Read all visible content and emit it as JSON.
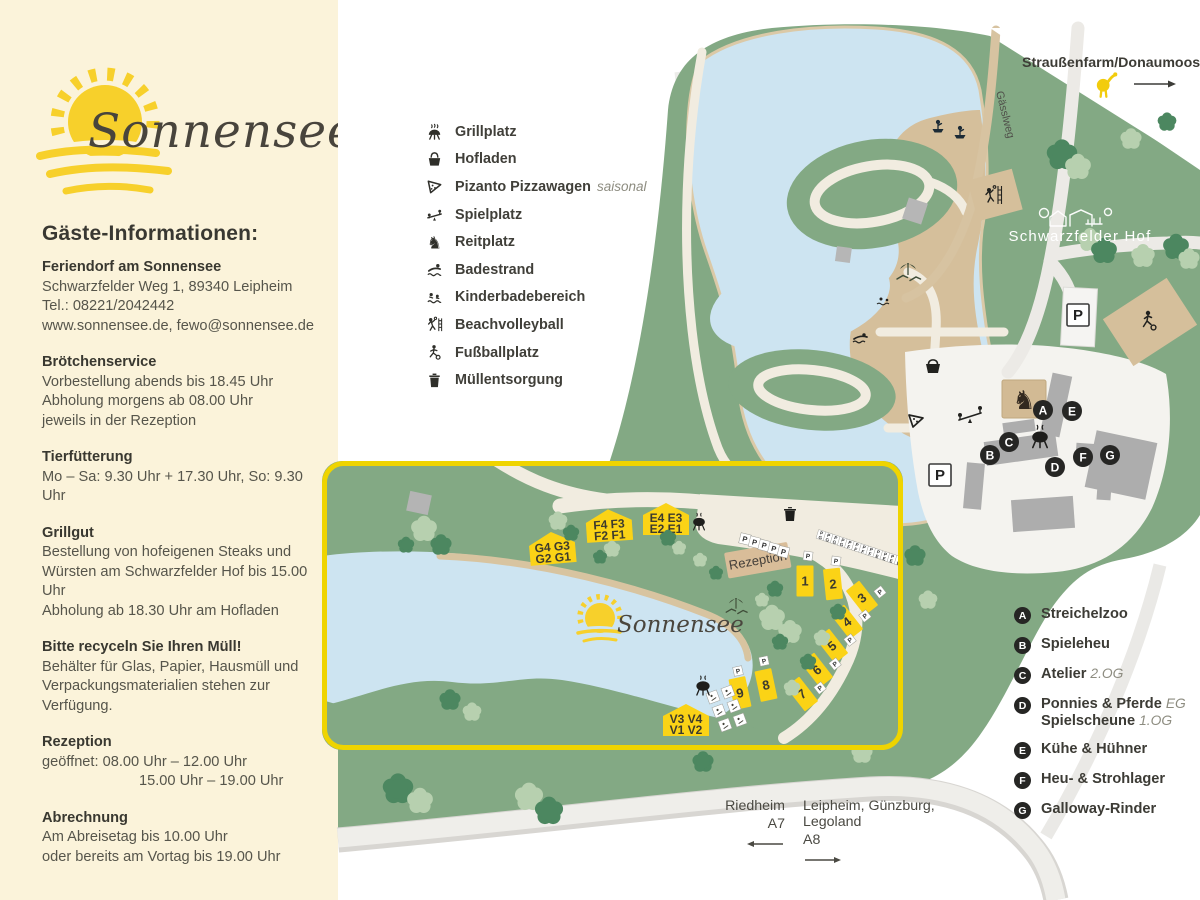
{
  "colors": {
    "sidebar_bg": "#fbf3da",
    "accent_yellow": "#fbd316",
    "inset_border": "#efd400",
    "map_green": "#83a984",
    "lake_blue": "#cde4f1",
    "beach_tan": "#d5bf9b",
    "marker_black": "#262624"
  },
  "sidebar": {
    "logo_text": "Sonnensee",
    "heading": "Gäste-Informationen:",
    "sections": [
      {
        "title": "Feriendorf am Sonnensee",
        "lines": [
          "Schwarzfelder Weg 1, 89340 Leipheim",
          "Tel.: 08221/2042442",
          "www.sonnensee.de, fewo@sonnensee.de"
        ]
      },
      {
        "title": "Brötchenservice",
        "lines": [
          "Vorbestellung abends bis 18.45 Uhr",
          "Abholung morgens ab 08.00 Uhr",
          "jeweils in der Rezeption"
        ]
      },
      {
        "title": "Tierfütterung",
        "lines": [
          "Mo – Sa: 9.30 Uhr + 17.30 Uhr, So: 9.30 Uhr"
        ]
      },
      {
        "title": "Grillgut",
        "lines": [
          "Bestellung von hofeigenen Steaks und",
          "Würsten am Schwarzfelder Hof bis 15.00 Uhr",
          "Abholung ab 18.30 Uhr am Hofladen"
        ]
      },
      {
        "title": "Bitte recyceln Sie Ihren Müll!",
        "lines": [
          "Behälter für Glas, Papier, Hausmüll und",
          "Verpackungsmaterialien stehen zur Verfügung."
        ]
      },
      {
        "title": "Rezeption",
        "lines": [
          "geöffnet: 08.00 Uhr – 12.00 Uhr",
          "15.00 Uhr – 19.00 Uhr"
        ],
        "indent_lines": [
          1
        ]
      },
      {
        "title": "Abrechnung",
        "lines": [
          "Am Abreisetag bis 10.00 Uhr",
          "oder bereits am Vortag bis 19.00 Uhr"
        ]
      }
    ]
  },
  "facilities_legend": [
    {
      "icon": "grill-icon",
      "label": "Grillplatz"
    },
    {
      "icon": "farm-shop-basket-icon",
      "label": "Hofladen"
    },
    {
      "icon": "pizza-icon",
      "label": "Pizanto Pizzawagen",
      "note": "saisonal"
    },
    {
      "icon": "playground-icon",
      "label": "Spielplatz"
    },
    {
      "icon": "horse-riding-icon",
      "label": "Reitplatz"
    },
    {
      "icon": "swimmer-icon",
      "label": "Badestrand"
    },
    {
      "icon": "kids-swim-icon",
      "label": "Kinderbadebereich"
    },
    {
      "icon": "volleyball-icon",
      "label": "Beachvolleyball"
    },
    {
      "icon": "soccer-icon",
      "label": "Fußballplatz"
    },
    {
      "icon": "trash-icon",
      "label": "Müllentsorgung"
    }
  ],
  "map": {
    "north_note": "Straußenfarm/Donaumoos",
    "gaessl_label": "Gässlweg",
    "farm_label": "Schwarzfelder Hof",
    "parking": "P"
  },
  "inset": {
    "logo_text": "Sonnensee",
    "reception_label": "Rezeption",
    "parking": "P",
    "houses": [
      {
        "id": "G",
        "line1": "G4 G3",
        "line2": "G2 G1"
      },
      {
        "id": "F",
        "line1": "F4 F3",
        "line2": "F2 F1"
      },
      {
        "id": "E",
        "line1": "E4 E3",
        "line2": "E2 E1"
      },
      {
        "id": "V",
        "line1": "V3 V4",
        "line2": "V1 V2"
      }
    ],
    "cabins": [
      "1",
      "2",
      "3",
      "4",
      "5",
      "6",
      "7",
      "8",
      "9"
    ],
    "parking_assignments": [
      "G",
      "G",
      "G",
      "G",
      "F",
      "F",
      "F",
      "F",
      "E",
      "E",
      "E",
      "E"
    ]
  },
  "building_legend": [
    {
      "key": "A",
      "label": "Streichelzoo"
    },
    {
      "key": "B",
      "label": "Spieleheu"
    },
    {
      "key": "C",
      "label": "Atelier",
      "note": "2.OG"
    },
    {
      "key": "D",
      "label": "Ponnies & Pferde",
      "note": "EG",
      "label2": "Spielscheune",
      "note2": "1.OG"
    },
    {
      "key": "E",
      "label": "Kühe & Hühner"
    },
    {
      "key": "F",
      "label": "Heu- & Strohlager"
    },
    {
      "key": "G",
      "label": "Galloway-Rinder"
    }
  ],
  "directions": {
    "left": {
      "place": "Riedheim",
      "road": "A7"
    },
    "right": {
      "place": "Leipheim, Günzburg, Legoland",
      "road": "A8"
    }
  }
}
